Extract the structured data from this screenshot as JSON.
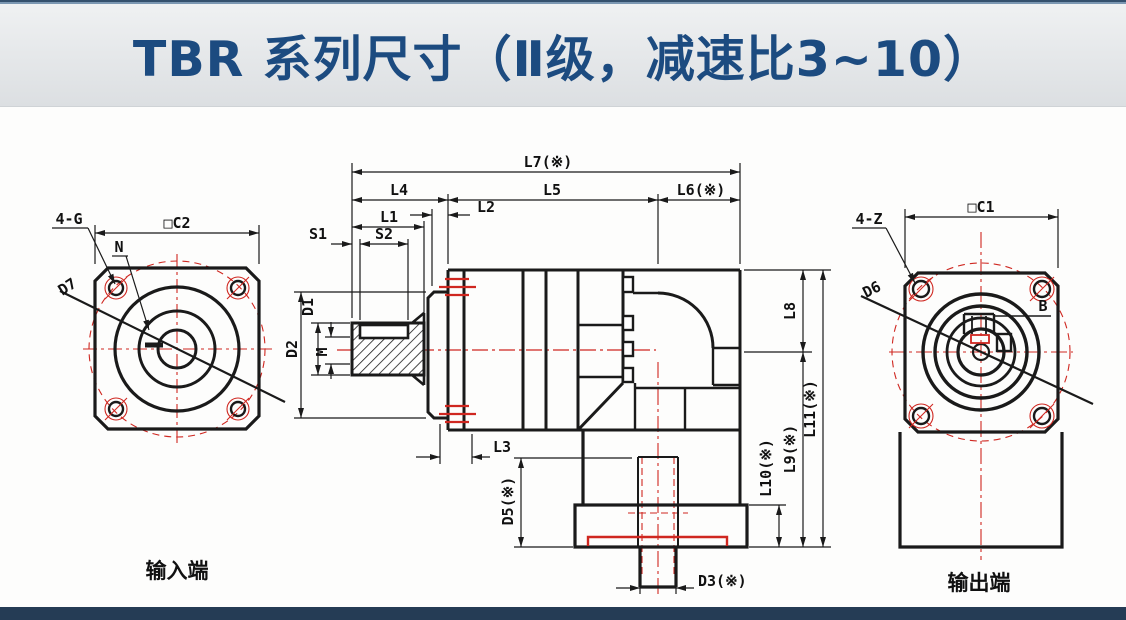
{
  "banner": {
    "title": "TBR 系列尺寸（Ⅱ级，减速比3~10）"
  },
  "colors": {
    "line": "#1a1a1a",
    "red": "#cf2720",
    "banner_text": "#1c4b80",
    "top_bar_dark": "#33506d",
    "top_bar_light": "#7b97b2",
    "bottom_bar": "#253c55",
    "banner_bg_top": "#eff1f2",
    "banner_bg_bottom": "#dcdfe2",
    "canvas_bg": "#fdfdfc"
  },
  "left_view": {
    "caption": "输入端",
    "labels": {
      "bolt_pattern": "4-G",
      "square_size": "□C2",
      "pilot": "N",
      "bolt_circle": "D7"
    }
  },
  "middle_view": {
    "dims_top": {
      "l7": "L7(※)",
      "l4": "L4",
      "l5": "L5",
      "l6": "L6(※)",
      "l2": "L2",
      "l1": "L1",
      "s1": "S1",
      "s2": "S2"
    },
    "dims_left": {
      "d1": "D1",
      "d2": "D2",
      "m": "M"
    },
    "dims_right": {
      "l8": "L8",
      "l9": "L9(※)",
      "l10": "L10(※)",
      "l11": "L11(※)"
    },
    "dims_bottom": {
      "l3": "L3",
      "d5": "D5(※)",
      "d3": "D3(※)"
    }
  },
  "right_view": {
    "caption": "输出端",
    "labels": {
      "bolt_pattern": "4-Z",
      "square_size": "□C1",
      "shaft": "D6",
      "key": "B"
    }
  }
}
